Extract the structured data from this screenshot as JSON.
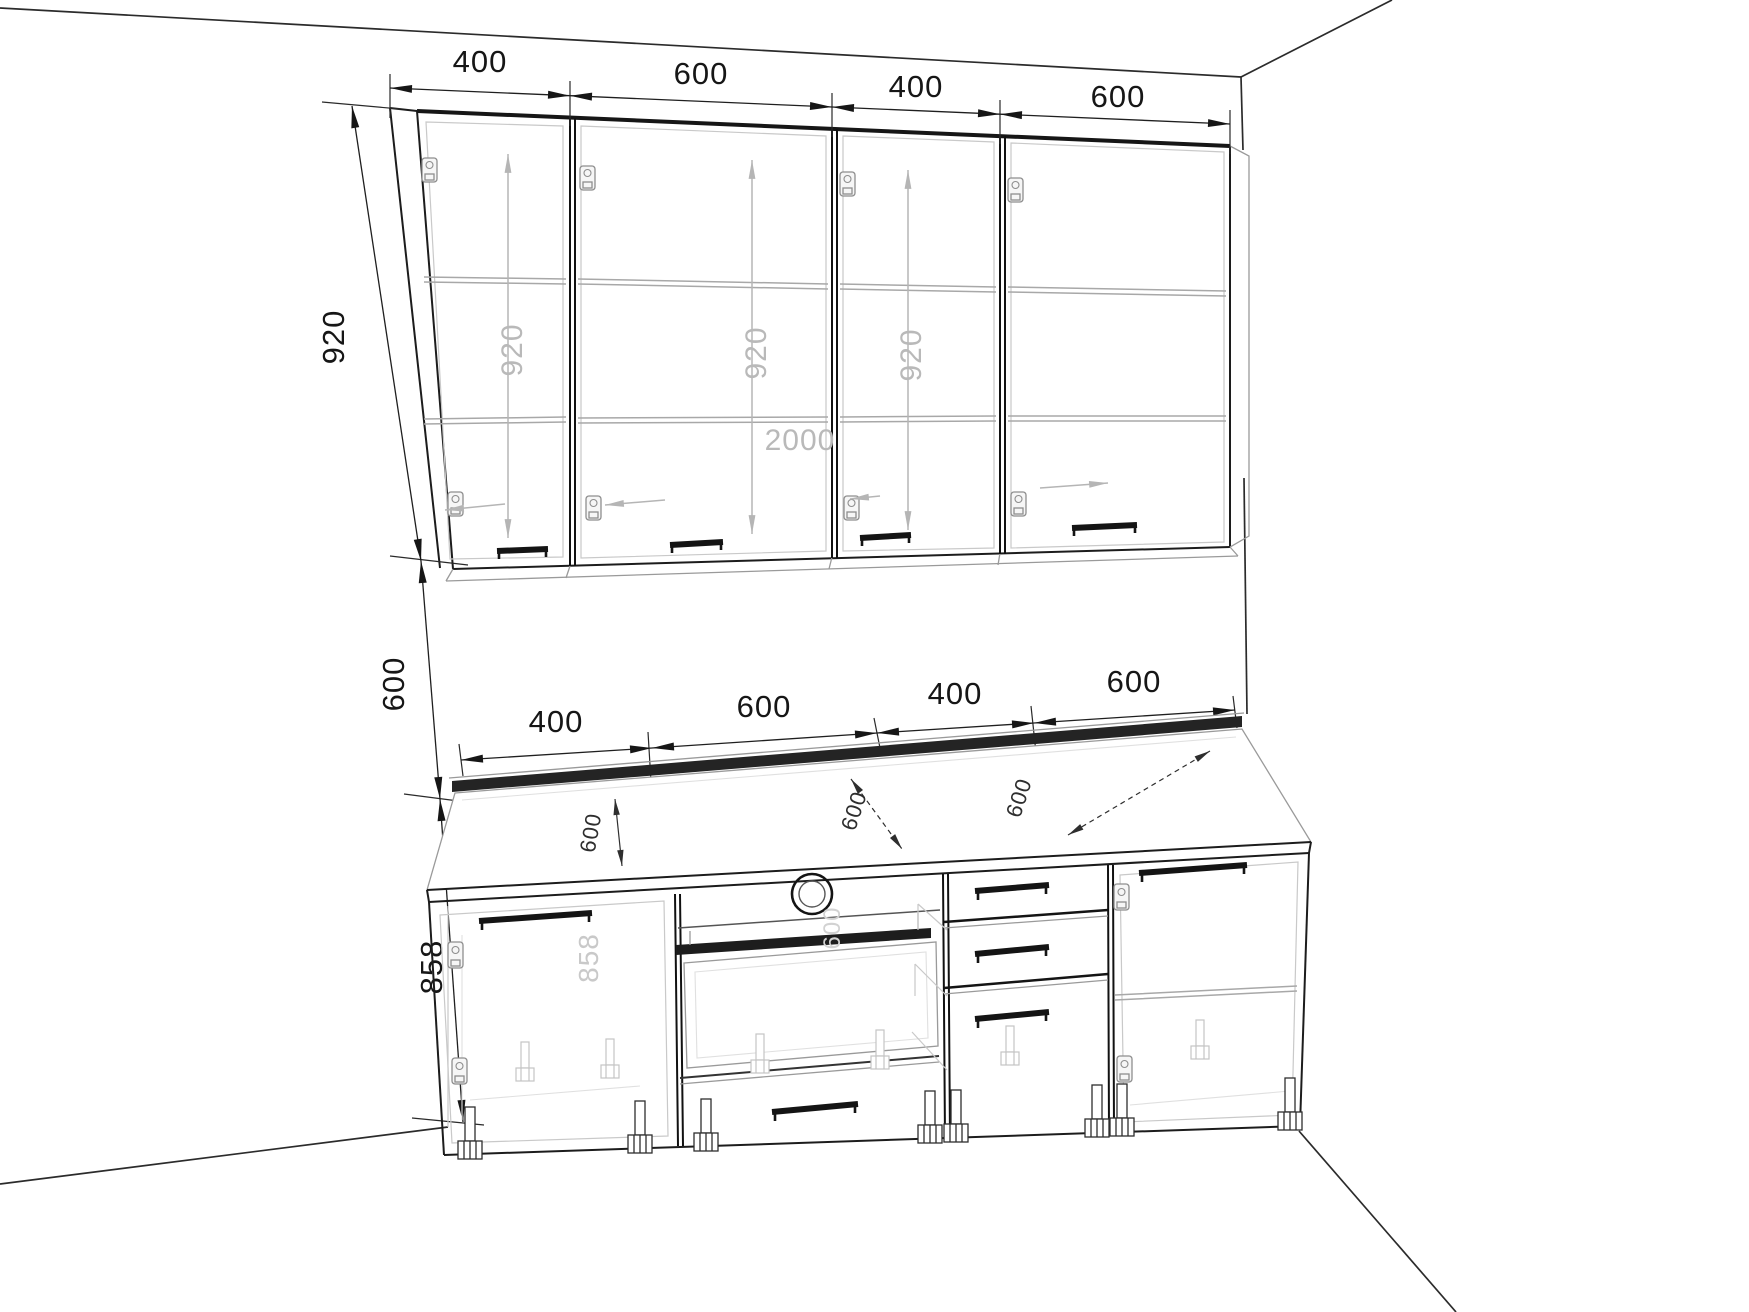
{
  "title": "Kitchen cabinet set - dimensioned wireframe elevation drawing",
  "colors": {
    "line": "#1c1c1c",
    "ghost_line": "#b5b5b5",
    "dark_fill": "#222222",
    "background": "#ffffff"
  },
  "dimensions": {
    "wall_row_widths": [
      "400",
      "600",
      "400",
      "600"
    ],
    "base_row_widths": [
      "400",
      "600",
      "400",
      "600"
    ],
    "wall_cabinet_height": "920",
    "splashback_gap_height": "600",
    "base_height": "858",
    "counter_depths": [
      "600",
      "600",
      "600"
    ],
    "ghost_wall_heights": [
      "920",
      "920",
      "920"
    ],
    "ghost_total_width": "2000",
    "ghost_base_height": "858",
    "ghost_base_depth": "600"
  }
}
